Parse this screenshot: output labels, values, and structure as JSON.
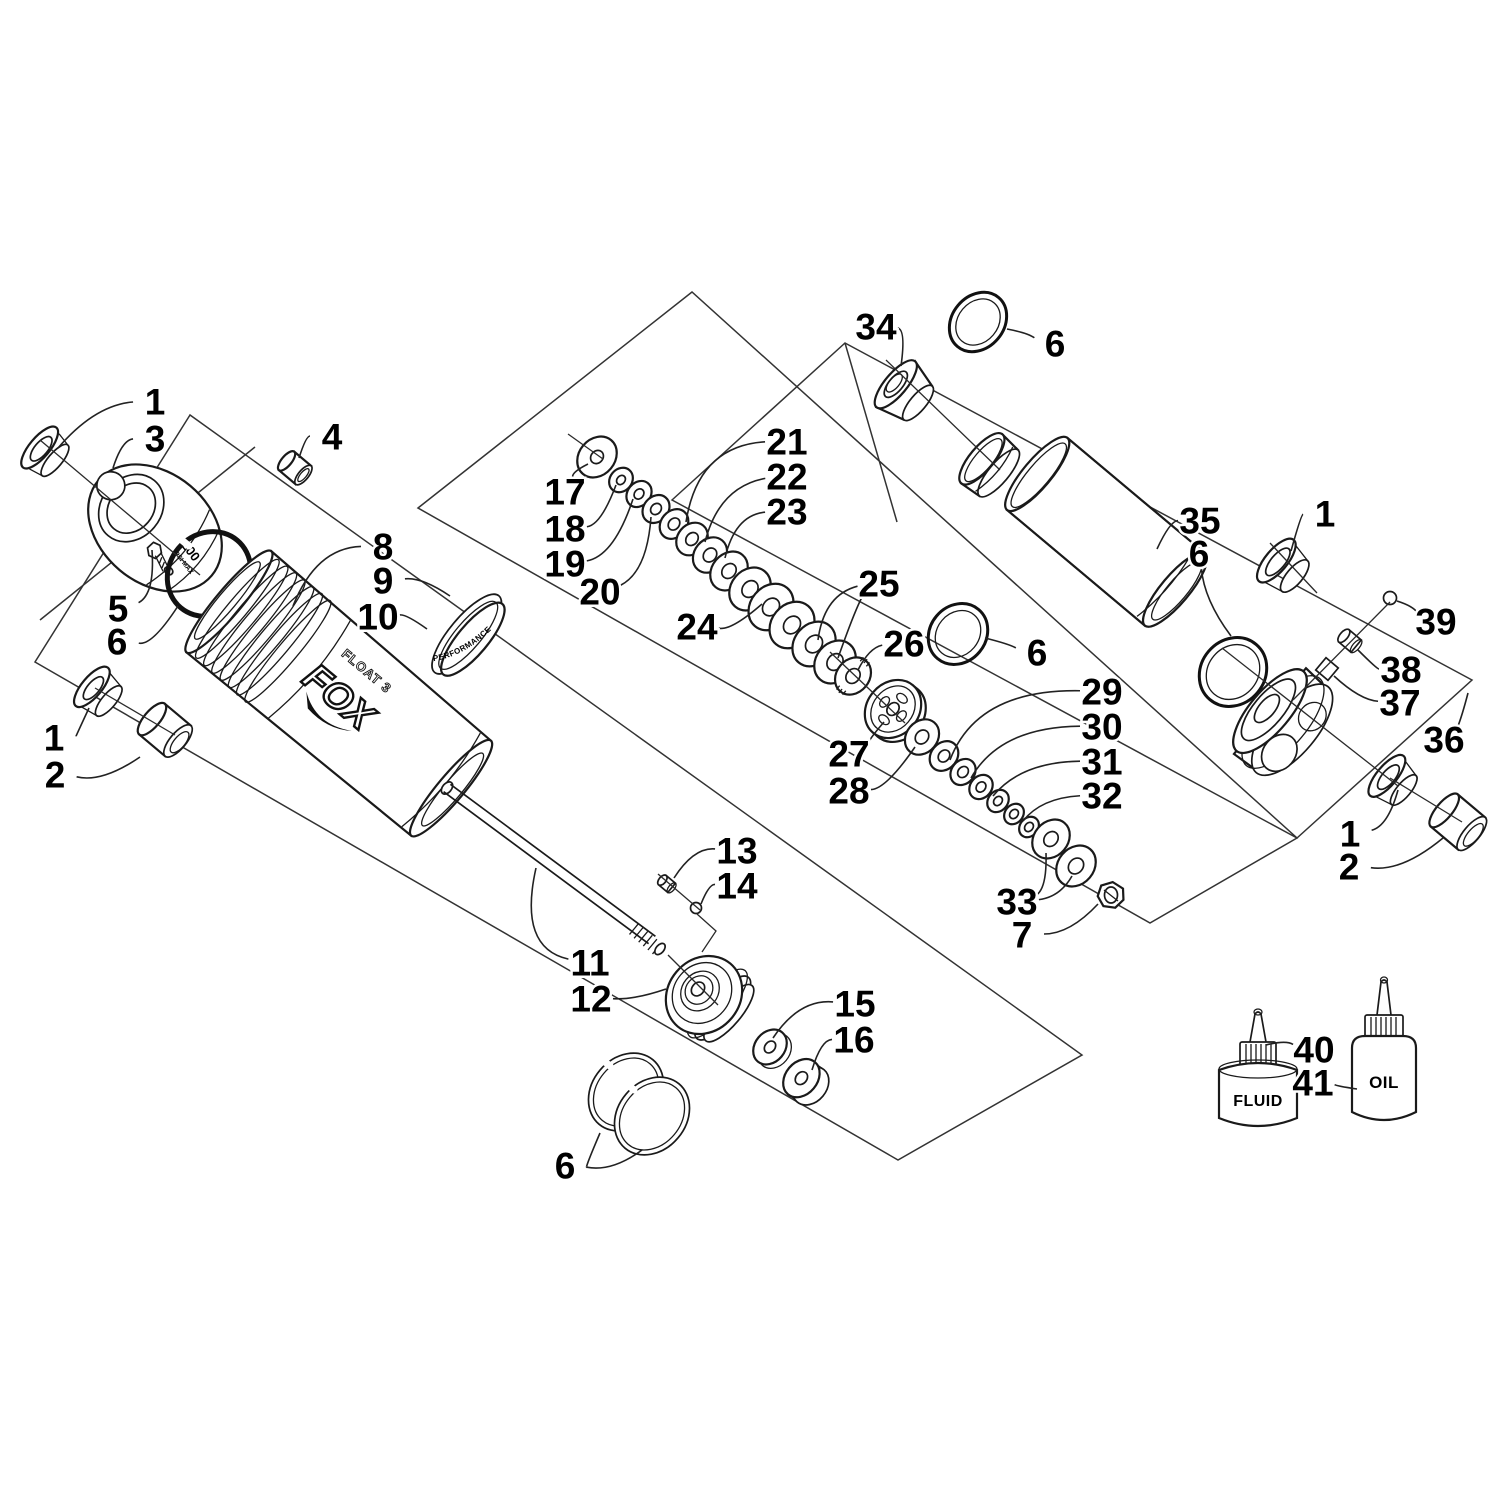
{
  "canvas": {
    "width": 1500,
    "height": 1500,
    "background": "#ffffff",
    "line_color": "#1a1a1a",
    "label_color": "#000000",
    "label_font_size": 37
  },
  "texts": {
    "brand": "FOX",
    "model": "FLOAT 3",
    "pressure_value": "200",
    "pressure_units": "PSI MAX",
    "band_text": "PERFORMANCE",
    "bottle_fluid_label": "FLUID",
    "bottle_oil_label": "OIL"
  },
  "callouts": [
    {
      "n": "1",
      "x": 155,
      "y": 401,
      "l": [
        [
          95,
          405,
          58,
          448
        ]
      ]
    },
    {
      "n": "3",
      "x": 155,
      "y": 438,
      "l": [
        [
          122,
          440,
          113,
          468
        ]
      ]
    },
    {
      "n": "4",
      "x": 332,
      "y": 436,
      "l": [
        [
          306,
          436,
          299,
          458
        ]
      ]
    },
    {
      "n": "5",
      "x": 118,
      "y": 608,
      "l": [
        [
          155,
          594,
          152,
          550
        ]
      ]
    },
    {
      "n": "6",
      "x": 117,
      "y": 641,
      "l": [
        [
          152,
          646,
          178,
          606
        ]
      ]
    },
    {
      "n": "8",
      "x": 383,
      "y": 546,
      "l": [
        [
          316,
          548,
          293,
          606
        ]
      ]
    },
    {
      "n": "9",
      "x": 383,
      "y": 580,
      "l": [
        [
          422,
          577,
          450,
          596
        ]
      ]
    },
    {
      "n": "10",
      "x": 378,
      "y": 616,
      "l": [
        [
          406,
          614,
          427,
          629
        ]
      ]
    },
    {
      "n": "1",
      "x": 54,
      "y": 737,
      "l": [
        [
          76,
          736,
          89,
          708
        ]
      ]
    },
    {
      "n": "2",
      "x": 55,
      "y": 774,
      "l": [
        [
          102,
          783,
          140,
          757
        ]
      ]
    },
    {
      "n": "11",
      "x": 590,
      "y": 962,
      "l": [
        [
          518,
          948,
          536,
          868
        ]
      ]
    },
    {
      "n": "12",
      "x": 591,
      "y": 998,
      "l": [
        [
          634,
          1000,
          666,
          989
        ]
      ]
    },
    {
      "n": "13",
      "x": 737,
      "y": 850,
      "l": [
        [
          694,
          847,
          674,
          878
        ]
      ]
    },
    {
      "n": "14",
      "x": 737,
      "y": 885,
      "l": [
        [
          709,
          884,
          701,
          904
        ]
      ]
    },
    {
      "n": "15",
      "x": 855,
      "y": 1003,
      "l": [
        [
          799,
          999,
          773,
          1038
        ]
      ]
    },
    {
      "n": "16",
      "x": 854,
      "y": 1039,
      "l": [
        [
          821,
          1040,
          812,
          1070
        ]
      ]
    },
    {
      "n": "6",
      "x": 565,
      "y": 1165,
      "l": [
        [
          585,
          1168,
          600,
          1133
        ],
        [
          612,
          1172,
          642,
          1150
        ]
      ]
    },
    {
      "n": "17",
      "x": 565,
      "y": 491,
      "l": [
        [
          572,
          472,
          588,
          464
        ]
      ]
    },
    {
      "n": "18",
      "x": 565,
      "y": 528,
      "l": [
        [
          601,
          525,
          616,
          485
        ]
      ]
    },
    {
      "n": "19",
      "x": 565,
      "y": 563,
      "l": [
        [
          614,
          556,
          633,
          499
        ]
      ]
    },
    {
      "n": "20",
      "x": 600,
      "y": 591,
      "l": [
        [
          647,
          572,
          651,
          517
        ]
      ]
    },
    {
      "n": "21",
      "x": 787,
      "y": 441,
      "l": [
        [
          698,
          446,
          686,
          522
        ]
      ]
    },
    {
      "n": "22",
      "x": 787,
      "y": 476,
      "l": [
        [
          719,
          487,
          705,
          542
        ]
      ]
    },
    {
      "n": "23",
      "x": 787,
      "y": 511,
      "l": [
        [
          735,
          515,
          725,
          558
        ]
      ]
    },
    {
      "n": "24",
      "x": 697,
      "y": 626,
      "l": [
        [
          731,
          631,
          762,
          604
        ]
      ]
    },
    {
      "n": "25",
      "x": 879,
      "y": 583,
      "l": [
        [
          824,
          595,
          818,
          640
        ],
        [
          856,
          607,
          838,
          658
        ]
      ]
    },
    {
      "n": "26",
      "x": 904,
      "y": 643,
      "l": [
        [
          869,
          648,
          858,
          670
        ]
      ]
    },
    {
      "n": "6",
      "x": 1037,
      "y": 652,
      "l": [
        [
          1009,
          644,
          985,
          638
        ]
      ]
    },
    {
      "n": "27",
      "x": 849,
      "y": 753,
      "l": [
        [
          865,
          744,
          884,
          722
        ]
      ]
    },
    {
      "n": "28",
      "x": 849,
      "y": 790,
      "l": [
        [
          886,
          789,
          915,
          747
        ]
      ]
    },
    {
      "n": "29",
      "x": 1102,
      "y": 691,
      "l": [
        [
          977,
          689,
          950,
          760
        ]
      ]
    },
    {
      "n": "30",
      "x": 1102,
      "y": 726,
      "l": [
        [
          1000,
          727,
          971,
          778
        ]
      ]
    },
    {
      "n": "31",
      "x": 1102,
      "y": 761,
      "l": [
        [
          1021,
          762,
          993,
          796
        ]
      ]
    },
    {
      "n": "32",
      "x": 1102,
      "y": 795,
      "l": [
        [
          1041,
          798,
          1023,
          821
        ]
      ]
    },
    {
      "n": "33",
      "x": 1017,
      "y": 901,
      "l": [
        [
          1047,
          887,
          1046,
          853
        ],
        [
          1060,
          897,
          1072,
          876
        ]
      ]
    },
    {
      "n": "7",
      "x": 1022,
      "y": 934,
      "l": [
        [
          1070,
          934,
          1098,
          904
        ]
      ]
    },
    {
      "n": "34",
      "x": 876,
      "y": 326,
      "l": [
        [
          906,
          330,
          901,
          366
        ]
      ]
    },
    {
      "n": "6",
      "x": 1055,
      "y": 343,
      "l": [
        [
          1028,
          333,
          1007,
          329
        ]
      ]
    },
    {
      "n": "35",
      "x": 1200,
      "y": 520,
      "l": [
        [
          1170,
          521,
          1157,
          549
        ]
      ]
    },
    {
      "n": "1",
      "x": 1325,
      "y": 513,
      "l": [
        [
          1301,
          515,
          1291,
          551
        ]
      ]
    },
    {
      "n": "6",
      "x": 1199,
      "y": 553,
      "l": [
        [
          1204,
          600,
          1231,
          636
        ]
      ]
    },
    {
      "n": "39",
      "x": 1436,
      "y": 621,
      "l": [
        [
          1413,
          606,
          1397,
          601
        ]
      ]
    },
    {
      "n": "38",
      "x": 1401,
      "y": 669,
      "l": [
        [
          1377,
          669,
          1358,
          650
        ]
      ]
    },
    {
      "n": "37",
      "x": 1400,
      "y": 702,
      "l": [
        [
          1360,
          700,
          1334,
          676
        ]
      ]
    },
    {
      "n": "36",
      "x": 1444,
      "y": 739,
      "l": [
        [
          1462,
          716,
          1468,
          693
        ]
      ]
    },
    {
      "n": "1",
      "x": 1350,
      "y": 833,
      "l": [
        [
          1388,
          826,
          1398,
          790
        ]
      ]
    },
    {
      "n": "2",
      "x": 1349,
      "y": 866,
      "l": [
        [
          1402,
          872,
          1443,
          838
        ]
      ]
    },
    {
      "n": "40",
      "x": 1314,
      "y": 1049,
      "l": [
        [
          1286,
          1040,
          1266,
          1045
        ]
      ]
    },
    {
      "n": "41",
      "x": 1313,
      "y": 1082,
      "l": [
        [
          1336,
          1086,
          1357,
          1089
        ]
      ]
    }
  ]
}
